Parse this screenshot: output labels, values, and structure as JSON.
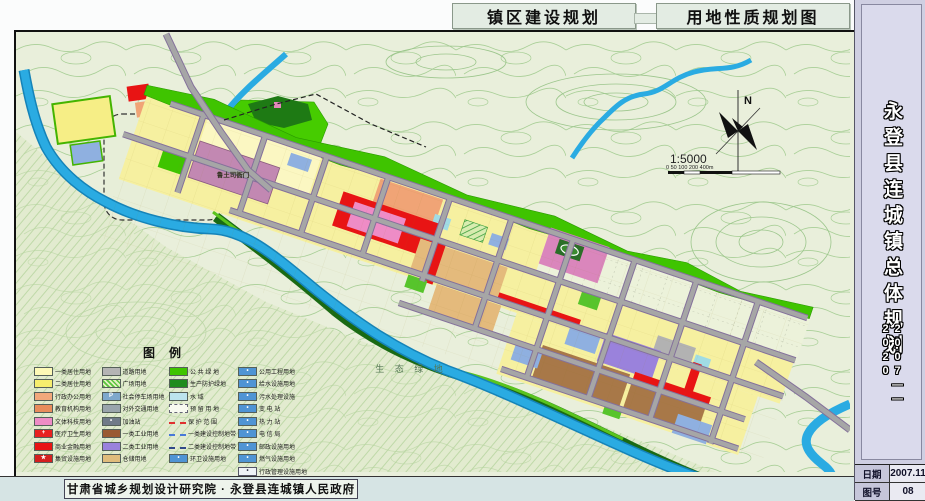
{
  "header": {
    "title_left": "镇区建设规划",
    "title_right": "用地性质规划图"
  },
  "sidebar": {
    "title": "永登县连城镇总体规划",
    "years": "2007——2020",
    "date_label": "日期",
    "date_value": "2007.11",
    "sheet_label": "图号",
    "sheet_value": "08"
  },
  "footer": {
    "credit": "甘肃省城乡规划设计研究院 · 永登县连城镇人民政府"
  },
  "map": {
    "labels": {
      "historic_site": "鲁土司衙门",
      "eco_green": "生 态 绿 地",
      "north": "N",
      "scale": "1:5000",
      "scale_ticks": "0   50  100        200                 400m"
    },
    "colors": {
      "topo_bg": "#e9efdb",
      "contour": "#a9cf97",
      "river": "#2aabe2",
      "road": "#a6a6a6",
      "road_casing": "#84719b",
      "public_green": "#3fc400",
      "protect_green": "#1e7a14",
      "residential_yellow": "#f6f0a0",
      "commercial_red": "#e81414",
      "historic_mauve": "#c288b2",
      "industry_brown": "#a87848",
      "industry_purple": "#9a82dc",
      "warehouse_tan": "#e4ba7c",
      "utility_blue": "#4f94d4"
    }
  },
  "legend": {
    "title": "图例",
    "col1": [
      {
        "label": "一类居住用地",
        "color": "#fdf9b6",
        "type": "fill",
        "symbol": ""
      },
      {
        "label": "二类居住用地",
        "color": "#f6ee6e",
        "type": "fill",
        "symbol": ""
      },
      {
        "label": "行政办公用地",
        "color": "#f2a87c",
        "type": "fill",
        "symbol": ""
      },
      {
        "label": "教育机构用地",
        "color": "#e88c5c",
        "type": "fill",
        "symbol": ""
      },
      {
        "label": "文体科技用地",
        "color": "#ee8cc6",
        "type": "fill",
        "symbol": ""
      },
      {
        "label": "医疗卫生用地",
        "color": "#e82020",
        "type": "fill",
        "symbol": "+"
      },
      {
        "label": "商业金融用地",
        "color": "#e81414",
        "type": "fill",
        "symbol": ""
      },
      {
        "label": "集贸设施用地",
        "color": "#d42020",
        "type": "fill",
        "symbol": "★"
      }
    ],
    "col2": [
      {
        "label": "道路用地",
        "color": "#b4b4b4",
        "type": "fill",
        "symbol": ""
      },
      {
        "label": "广场用地",
        "color": "#57c43c",
        "type": "hatch",
        "symbol": ""
      },
      {
        "label": "社会停车场用地",
        "color": "#7fa8cc",
        "type": "fill",
        "symbol": "P"
      },
      {
        "label": "对外交通用地",
        "color": "#9aa4ac",
        "type": "fill",
        "symbol": ""
      },
      {
        "label": "加油站",
        "color": "#707a88",
        "type": "fill",
        "symbol": "•"
      },
      {
        "label": "一类工业用地",
        "color": "#9a5a32",
        "type": "fill",
        "symbol": ""
      },
      {
        "label": "二类工业用地",
        "color": "#9a82dc",
        "type": "fill",
        "symbol": ""
      },
      {
        "label": "仓储用地",
        "color": "#e0bc7c",
        "type": "fill",
        "symbol": ""
      }
    ],
    "col3": [
      {
        "label": "公 共 绿 地",
        "color": "#3fc400",
        "type": "fill",
        "symbol": ""
      },
      {
        "label": "生产防护绿地",
        "color": "#1e8c1e",
        "type": "fill",
        "symbol": ""
      },
      {
        "label": "水    域",
        "color": "#bce4ee",
        "type": "fill",
        "symbol": ""
      },
      {
        "label": "预 留 用 地",
        "color": "#f6f8ee",
        "type": "outline",
        "symbol": ""
      },
      {
        "label": "保 护 范 围",
        "color": "#e03030",
        "type": "dash",
        "symbol": ""
      },
      {
        "label": "一类建设控制地带",
        "color": "#4878d8",
        "type": "dash",
        "symbol": ""
      },
      {
        "label": "二类建设控制地带",
        "color": "#304888",
        "type": "dash",
        "symbol": ""
      },
      {
        "label": "环卫设施用地",
        "color": "#4f94d4",
        "type": "fill",
        "symbol": "•"
      }
    ],
    "col4": [
      {
        "label": "公用工程用地",
        "color": "#4f94d4",
        "type": "fill",
        "symbol": "•"
      },
      {
        "label": "给水设施用地",
        "color": "#4f94d4",
        "type": "fill",
        "symbol": "•"
      },
      {
        "label": "污水处理设施",
        "color": "#4f94d4",
        "type": "fill",
        "symbol": "•"
      },
      {
        "label": "变 电 站",
        "color": "#4f94d4",
        "type": "fill",
        "symbol": "•"
      },
      {
        "label": "热 力 站",
        "color": "#4f94d4",
        "type": "fill",
        "symbol": "•"
      },
      {
        "label": "电 信 局",
        "color": "#4f94d4",
        "type": "fill",
        "symbol": "•"
      },
      {
        "label": "邮政设施用地",
        "color": "#4f94d4",
        "type": "fill",
        "symbol": "•"
      },
      {
        "label": "燃气设施用地",
        "color": "#4f94d4",
        "type": "fill",
        "symbol": "•"
      },
      {
        "label": "行政管理设施用地",
        "color": "#eef2f6",
        "type": "outline2",
        "symbol": "•"
      }
    ]
  }
}
